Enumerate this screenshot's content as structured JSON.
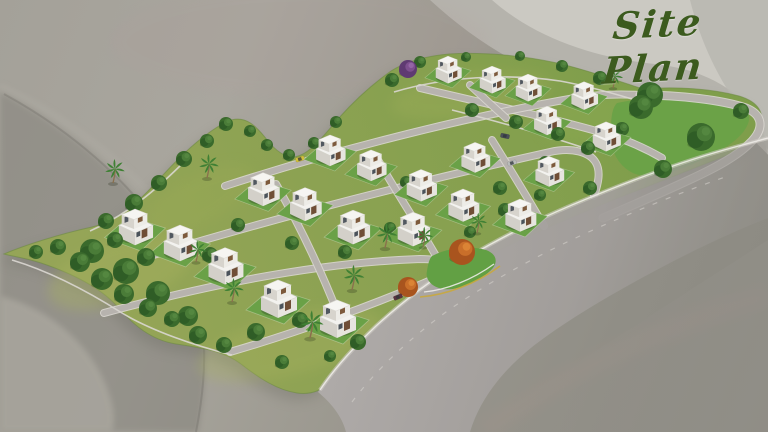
{
  "title": {
    "text": "Site Plan",
    "color": "#3c5b1e"
  },
  "palette": {
    "grass1": "#95a557",
    "grass2": "#7f9e4b",
    "park": "#6ba247",
    "lawn": "#6aa147",
    "corner": "#62a044",
    "road": "#b7b3ae",
    "road_edge": "#dad7d1",
    "main_hi": "#aeaaa8",
    "main_lo": "#92908a",
    "line_white": "#edebe7",
    "line_dash": "#d8d5d0",
    "line_yellow": "#c9a93d",
    "wall": "#dad7d1",
    "dome_outer": "#b5b3ac",
    "dome_bright": "#cbc9c2",
    "dome_corner": "#b9b7b0",
    "swoosh_dark": "#7e7c75",
    "swoosh_light": "#aaa79f",
    "arc_light": "#b6b3ab",
    "pink": "#b0968e",
    "site_rim": "#6d8a42",
    "site_shadow": "#64645a",
    "tree1": "#4a7c38",
    "tree2": "#3a6a2c",
    "tree3": "#2f5c26",
    "tree_hi": "#568a42",
    "palm": "#3f8034",
    "trunk": "#8a6f4d",
    "purple1": "#7d4f8e",
    "purple2": "#5f3a72",
    "orange1": "#c96f2a",
    "orange2": "#a8541e",
    "villa_roof": "#f3f2ef",
    "villa_roof2": "#f6f5f2",
    "villa_faceR": "#e7e5df",
    "villa_faceL": "#d3d0c9",
    "villa_faceR2": "#edece7",
    "villa_faceL2": "#d7d4cd",
    "wood": "#6f4e36",
    "wood2": "#7d5a3c",
    "window": "#3a424c"
  },
  "bg": {
    "dome_outer": "M 430,0 C 495,60 570,95 655,105 C 710,112 745,128 768,155 L 768,0 Z",
    "dome_bright": "M 492,0 C 535,38 595,58 655,64 C 700,69 735,86 757,118 C 763,128 766,140 767,154 L 768,154 L 768,0 Z",
    "dome_corner": "M 690,0 C 700,40 718,80 745,115 C 755,128 762,140 768,150 L 768,0 Z",
    "swoosh_dark": "M 0,92 C 68,128 128,178 168,238 C 204,292 214,342 198,432 L 0,432 Z",
    "swoosh_edge": "M 196,432 C 214,340 202,288 166,236 C 128,180 70,130 4,94",
    "swoosh_light": "M 0,296 C 42,306 82,336 102,376 C 114,402 116,418 112,432 L 0,432 Z",
    "arc": "M 0,86 C 80,122 152,184 194,252",
    "pink_arc": "M 768,296 C 660,326 560,376 484,432",
    "pink_top": {
      "cx": 300,
      "cy": 42,
      "rx": 190,
      "ry": 55
    }
  },
  "site": {
    "outline": "M 4,254 C 25,245 60,234 92,227 C 122,220 142,198 163,175 C 184,152 206,132 228,121 C 246,114 257,127 268,141 C 276,151 285,157 293,157 C 308,156 321,139 338,119 C 354,101 370,86 391,71 C 407,61 426,56 449,54 C 481,52 521,55 557,63 C 587,70 618,81 643,89 C 676,86 713,89 739,96 C 759,102 766,114 759,129 C 752,144 736,152 720,158 C 692,169 664,180 636,191 C 604,203 570,218 536,233 C 500,249 466,267 434,286 C 410,300 388,317 368,336 C 352,352 338,366 330,380 C 324,390 312,395 297,393 C 277,390 259,378 241,364 C 224,351 202,348 176,344 C 151,340 133,325 116,305 C 99,287 71,273 41,263 C 22,257 10,256 4,254 Z"
  },
  "park": "M 617,103 C 650,96 700,94 728,99 C 747,103 753,114 747,126 C 739,142 717,153 695,163 C 669,175 645,180 631,172 C 617,164 611,150 611,136 C 611,121 611,109 617,103 Z",
  "corner_patch": "M 432,256 C 448,248 468,245 486,250 C 497,254 499,263 490,271 C 477,283 457,291 443,289 C 431,287 425,279 427,271 C 428,265 429,259 432,256 Z",
  "texture": [
    {
      "x": 120,
      "y": 272,
      "rx": 75,
      "ry": 32,
      "rot": -18,
      "c": "#a7b15e",
      "o": 0.4
    },
    {
      "x": 290,
      "y": 345,
      "rx": 95,
      "ry": 30,
      "rot": -14,
      "c": "#a7b15e",
      "o": 0.35
    },
    {
      "x": 470,
      "y": 95,
      "rx": 80,
      "ry": 22,
      "rot": -8,
      "c": "#9fae58",
      "o": 0.35
    },
    {
      "x": 600,
      "y": 120,
      "rx": 60,
      "ry": 26,
      "rot": -8,
      "c": "#8fb052",
      "o": 0.3
    },
    {
      "x": 200,
      "y": 200,
      "rx": 60,
      "ry": 24,
      "rot": -28,
      "c": "#9cab56",
      "o": 0.3
    }
  ],
  "roads": {
    "streets": [
      "M 420,88 C 470,100 540,115 600,132 C 625,139 645,148 662,158",
      "M 225,186 C 330,152 460,118 575,98 C 600,94 622,94 640,95",
      "M 150,256 C 282,216 420,181 550,152 C 572,147 590,152 596,163 C 601,172 598,184 594,196",
      "M 104,313 C 222,281 330,262 420,259 C 432,259 442,261 448,264",
      "M 230,352 C 302,331 372,305 424,283 C 432,280 438,276 443,272",
      "M 276,184 C 300,226 320,268 338,314",
      "M 378,160 C 400,198 420,228 436,256",
      "M 492,140 C 512,172 530,202 544,226",
      "M 470,85 C 486,100 497,110 506,118"
    ],
    "perimeter": "M 640,95 C 680,95 722,100 746,108 C 763,115 764,128 752,141 C 738,156 715,168 689,180 C 661,193 631,206 603,218",
    "main": {
      "body": "M 318,392 C 330,372 350,350 374,328 C 398,306 426,284 458,264 C 492,243 530,224 570,207 C 622,185 676,165 722,152 C 740,147 756,143 768,140 L 768,218 C 742,228 706,244 668,264 C 624,287 580,312 544,338 C 512,361 482,392 470,432 L 346,432 C 342,416 331,403 318,392 Z",
      "fade": "M 470,432 L 768,240 L 768,432 Z",
      "edge": "M 320,390 C 334,369 354,347 376,326 C 400,304 428,282 460,262 C 494,241 532,222 572,205 C 624,183 678,163 724,150 C 742,145 757,141 768,138",
      "dash": "M 352,402 C 376,370 408,340 446,312 C 486,284 532,258 582,235 C 632,212 682,192 728,176",
      "curb_white": "M 424,292 C 446,290 472,280 494,264",
      "curb_yellow": "M 420,297 C 446,295 476,284 500,266"
    }
  },
  "walls": [
    "M 90,231 C 128,214 156,190 186,160",
    "M 12,260 C 52,272 92,294 122,313 C 152,331 196,346 232,355",
    "M 394,92 C 444,77 506,73 560,81 C 588,86 612,93 632,99",
    "M 452,110 C 500,122 550,136 596,152"
  ],
  "villas": [
    [
      448,
      72,
      0.72
    ],
    [
      492,
      82,
      0.72
    ],
    [
      528,
      90,
      0.72
    ],
    [
      584,
      98,
      0.74
    ],
    [
      547,
      123,
      0.76
    ],
    [
      606,
      139,
      0.78
    ],
    [
      475,
      160,
      0.8
    ],
    [
      549,
      174,
      0.8
    ],
    [
      330,
      153,
      0.82
    ],
    [
      371,
      168,
      0.82
    ],
    [
      421,
      188,
      0.84
    ],
    [
      463,
      208,
      0.86
    ],
    [
      520,
      218,
      0.86
    ],
    [
      263,
      192,
      0.88
    ],
    [
      305,
      207,
      0.88
    ],
    [
      353,
      230,
      0.9
    ],
    [
      413,
      232,
      0.9
    ],
    [
      135,
      230,
      0.95
    ],
    [
      180,
      246,
      0.95
    ],
    [
      225,
      269,
      0.97
    ],
    [
      278,
      302,
      1.0
    ],
    [
      337,
      322,
      1.0
    ]
  ],
  "trees": [
    [
      36,
      252,
      7
    ],
    [
      58,
      247,
      8
    ],
    [
      80,
      262,
      10
    ],
    [
      102,
      279,
      11
    ],
    [
      124,
      294,
      10
    ],
    [
      148,
      308,
      9
    ],
    [
      172,
      319,
      8
    ],
    [
      198,
      335,
      9
    ],
    [
      224,
      345,
      8
    ],
    [
      92,
      251,
      12
    ],
    [
      126,
      271,
      13
    ],
    [
      158,
      293,
      12
    ],
    [
      188,
      316,
      10
    ],
    [
      146,
      257,
      9
    ],
    [
      115,
      240,
      8
    ],
    [
      106,
      221,
      8
    ],
    [
      134,
      203,
      9
    ],
    [
      159,
      183,
      8
    ],
    [
      184,
      159,
      8
    ],
    [
      207,
      141,
      7
    ],
    [
      226,
      124,
      7
    ],
    [
      250,
      131,
      6
    ],
    [
      267,
      145,
      6
    ],
    [
      289,
      155,
      6
    ],
    [
      314,
      143,
      6
    ],
    [
      336,
      122,
      6
    ],
    [
      210,
      255,
      8
    ],
    [
      238,
      225,
      7
    ],
    [
      292,
      243,
      7
    ],
    [
      345,
      252,
      7
    ],
    [
      390,
      228,
      6
    ],
    [
      300,
      320,
      8
    ],
    [
      358,
      342,
      8
    ],
    [
      256,
      332,
      9
    ],
    [
      406,
      182,
      6
    ],
    [
      500,
      188,
      7
    ],
    [
      505,
      210,
      7
    ],
    [
      540,
      195,
      6
    ],
    [
      545,
      162,
      6
    ],
    [
      470,
      232,
      6
    ],
    [
      392,
      80,
      7
    ],
    [
      420,
      62,
      6
    ],
    [
      466,
      57,
      5
    ],
    [
      520,
      56,
      5
    ],
    [
      562,
      66,
      6
    ],
    [
      600,
      78,
      7
    ],
    [
      472,
      110,
      7
    ],
    [
      516,
      122,
      7
    ],
    [
      558,
      134,
      7
    ],
    [
      588,
      148,
      7
    ],
    [
      641,
      107,
      12
    ],
    [
      701,
      137,
      14
    ],
    [
      663,
      169,
      9
    ],
    [
      741,
      111,
      8
    ],
    [
      622,
      129,
      7
    ],
    [
      650,
      95,
      13
    ],
    [
      590,
      188,
      7
    ],
    [
      282,
      362,
      7
    ],
    [
      330,
      356,
      6
    ]
  ],
  "palms": [
    [
      113,
      183,
      1.0
    ],
    [
      207,
      178,
      1.0
    ],
    [
      196,
      262,
      0.9
    ],
    [
      232,
      302,
      1.0
    ],
    [
      310,
      338,
      1.15
    ],
    [
      352,
      290,
      1.05
    ],
    [
      385,
      248,
      1.05
    ],
    [
      423,
      247,
      0.85
    ],
    [
      477,
      233,
      0.85
    ],
    [
      613,
      88,
      0.85
    ]
  ],
  "purple_trees": [
    [
      408,
      69,
      9
    ]
  ],
  "orange_trees": [
    [
      462,
      252,
      13
    ],
    [
      408,
      287,
      10
    ]
  ],
  "cars": [
    [
      300,
      159,
      "#d2c03a",
      -17
    ],
    [
      294,
      212,
      "#ccba36",
      -17
    ],
    [
      512,
      163,
      "#b9bcba",
      -17
    ],
    [
      505,
      136,
      "#4a4f58",
      12
    ],
    [
      398,
      297,
      "#5a3340",
      -22
    ]
  ]
}
